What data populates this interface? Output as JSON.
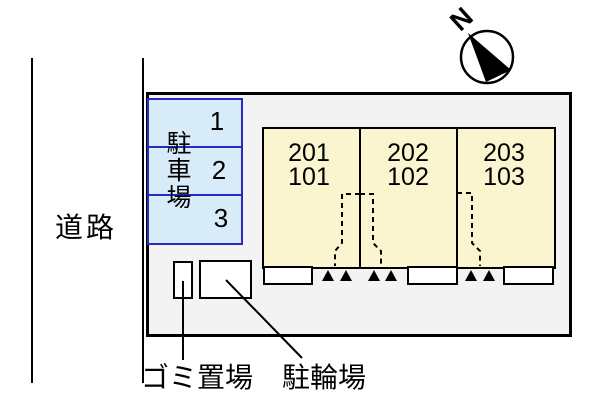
{
  "road_label": "道路",
  "north_label": "N",
  "parking": {
    "label": "駐車場",
    "spaces": [
      "1",
      "2",
      "3"
    ]
  },
  "building": {
    "units": [
      {
        "line1": "201",
        "line2": "101"
      },
      {
        "line1": "202",
        "line2": "102"
      },
      {
        "line1": "203",
        "line2": "103"
      }
    ]
  },
  "annotations": {
    "garbage_label": "ゴミ置場",
    "bicycle_label": "駐輪場"
  },
  "colors": {
    "plot_fill": "#f3f3f3",
    "building_fill": "#faf4cf",
    "parking_fill": "#d7ecf8",
    "parking_border": "#2a2ac2",
    "line": "#000000",
    "bg": "#ffffff"
  }
}
